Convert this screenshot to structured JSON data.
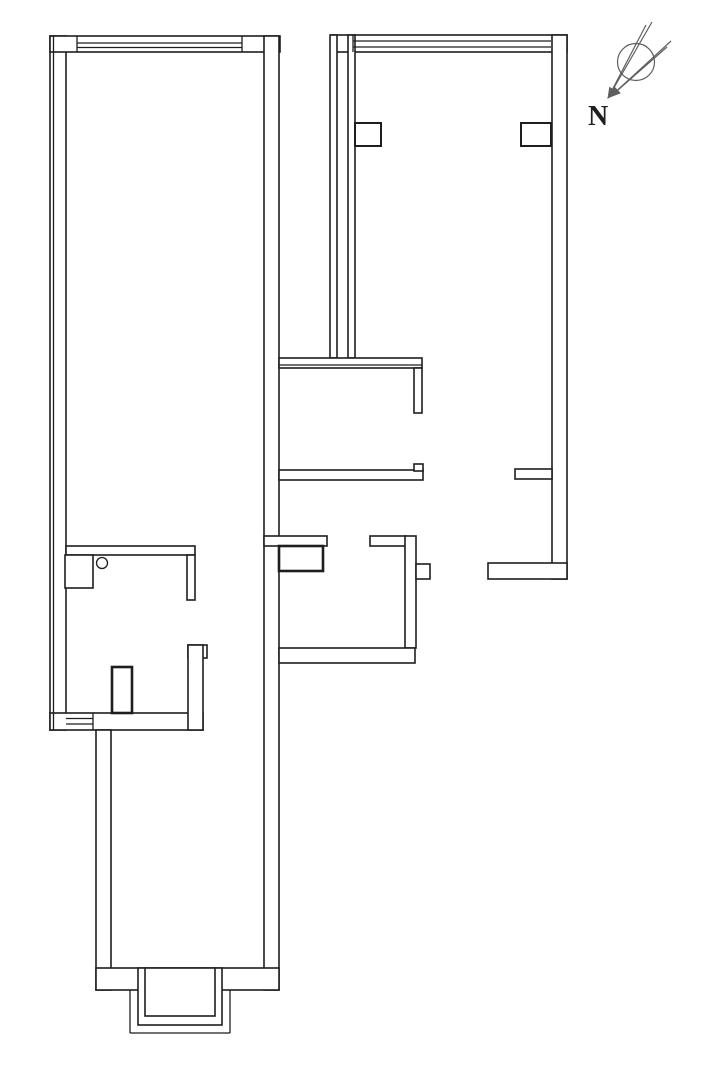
{
  "plan": {
    "title": "apartment-floor-plan",
    "canvas": {
      "width": 713,
      "height": 1074,
      "background": "#ffffff"
    },
    "colors": {
      "wall_stroke": "#1e1e1e",
      "wall_fill": "#ffffff",
      "thin_line": "#1e1e1e",
      "compass_stroke": "#5f5f5f",
      "label_color": "#1f1f1f"
    },
    "stroke_widths": {
      "wall": 1.6,
      "thick": 2.6,
      "line": 1.3,
      "compass": 1.2
    },
    "walls": [
      {
        "name": "outer-wall-left",
        "x": 50,
        "y": 36,
        "w": 16,
        "h": 694
      },
      {
        "name": "living-top-wall",
        "x": 50,
        "y": 36,
        "w": 230,
        "h": 16
      },
      {
        "name": "living-right-wall",
        "x": 264,
        "y": 36,
        "w": 15,
        "h": 954
      },
      {
        "name": "bedroom-top-wall",
        "x": 331,
        "y": 35,
        "w": 236,
        "h": 17
      },
      {
        "name": "bedroom-left-wall-outer",
        "x": 330,
        "y": 35,
        "w": 7,
        "h": 323
      },
      {
        "name": "bedroom-left-wall-inner",
        "x": 348,
        "y": 35,
        "w": 7,
        "h": 323
      },
      {
        "name": "bedroom-right-wall",
        "x": 552,
        "y": 35,
        "w": 15,
        "h": 544
      },
      {
        "name": "duct-box-left",
        "x": 355,
        "y": 123,
        "w": 26,
        "h": 23,
        "sw": 2.0
      },
      {
        "name": "duct-box-right",
        "x": 521,
        "y": 123,
        "w": 30,
        "h": 23,
        "sw": 2.0
      },
      {
        "name": "bath-top-wall",
        "x": 279,
        "y": 358,
        "w": 143,
        "h": 10
      },
      {
        "name": "bath-right-wall",
        "x": 414,
        "y": 368,
        "w": 8,
        "h": 45
      },
      {
        "name": "bath-bottom-wall",
        "x": 279,
        "y": 470,
        "w": 144,
        "h": 10
      },
      {
        "name": "bath-door-notch",
        "x": 414,
        "y": 464,
        "w": 9,
        "h": 7
      },
      {
        "name": "entry-stub-wall",
        "x": 515,
        "y": 469,
        "w": 37,
        "h": 10
      },
      {
        "name": "entry-bottom-wall",
        "x": 488,
        "y": 563,
        "w": 79,
        "h": 16
      },
      {
        "name": "kitchen-top-wall-left",
        "x": 264,
        "y": 536,
        "w": 63,
        "h": 10
      },
      {
        "name": "kitchen-top-wall-right",
        "x": 370,
        "y": 536,
        "w": 36,
        "h": 10
      },
      {
        "name": "kitchen-right-wall",
        "x": 405,
        "y": 536,
        "w": 11,
        "h": 112
      },
      {
        "name": "kitchen-stub-wall",
        "x": 416,
        "y": 564,
        "w": 14,
        "h": 15
      },
      {
        "name": "kitchen-bottom-wall",
        "x": 279,
        "y": 648,
        "w": 136,
        "h": 15
      },
      {
        "name": "kitchen-counter",
        "x": 279,
        "y": 546,
        "w": 44,
        "h": 25,
        "sw": 2.6
      },
      {
        "name": "bath2-top-wall",
        "x": 66,
        "y": 546,
        "w": 129,
        "h": 9
      },
      {
        "name": "bath2-right-wall",
        "x": 187,
        "y": 555,
        "w": 8,
        "h": 45
      },
      {
        "name": "washbasin",
        "x": 65,
        "y": 555,
        "w": 28,
        "h": 33
      },
      {
        "name": "hall-window-wall",
        "x": 50,
        "y": 713,
        "w": 153,
        "h": 17
      },
      {
        "name": "pipe-shaft",
        "x": 112,
        "y": 667,
        "w": 20,
        "h": 46,
        "sw": 2.6
      },
      {
        "name": "hall-wall-cap",
        "x": 188,
        "y": 645,
        "w": 19,
        "h": 13
      },
      {
        "name": "hall-wall",
        "x": 188,
        "y": 645,
        "w": 15,
        "h": 85
      },
      {
        "name": "balcony-room-left-wall",
        "x": 96,
        "y": 730,
        "w": 15,
        "h": 260
      },
      {
        "name": "balcony-bottom-wall-left",
        "x": 96,
        "y": 968,
        "w": 49,
        "h": 22
      },
      {
        "name": "balcony-bottom-wall-right",
        "x": 215,
        "y": 968,
        "w": 64,
        "h": 22
      },
      {
        "name": "bay-window-mid-rect",
        "x": 138,
        "y": 968,
        "w": 84,
        "h": 57
      },
      {
        "name": "bay-window-inner-rect",
        "x": 145,
        "y": 968,
        "w": 70,
        "h": 48
      }
    ],
    "lines": [
      {
        "name": "outer-wall-left-inner-line",
        "x1": 53.5,
        "y1": 36,
        "x2": 53.5,
        "y2": 730
      },
      {
        "name": "bath-top-wall-inner-line",
        "x1": 279,
        "y1": 365,
        "x2": 422,
        "y2": 365
      },
      {
        "name": "window-living-line-1",
        "x1": 77,
        "y1": 43,
        "x2": 242,
        "y2": 43
      },
      {
        "name": "window-living-line-2",
        "x1": 77,
        "y1": 47.5,
        "x2": 242,
        "y2": 47.5
      },
      {
        "name": "window-living-jamb-left",
        "x1": 77,
        "y1": 36,
        "x2": 77,
        "y2": 52
      },
      {
        "name": "window-living-jamb-right",
        "x1": 242,
        "y1": 36,
        "x2": 242,
        "y2": 52
      },
      {
        "name": "window-bedroom-line-1",
        "x1": 353,
        "y1": 41,
        "x2": 551,
        "y2": 41
      },
      {
        "name": "window-bedroom-line-2",
        "x1": 353,
        "y1": 47,
        "x2": 551,
        "y2": 47
      },
      {
        "name": "window-bedroom-jamb-left",
        "x1": 353,
        "y1": 35,
        "x2": 353,
        "y2": 52
      },
      {
        "name": "window-hall-line-1",
        "x1": 66,
        "y1": 718.5,
        "x2": 93,
        "y2": 718.5
      },
      {
        "name": "window-hall-line-2",
        "x1": 66,
        "y1": 724,
        "x2": 93,
        "y2": 724
      },
      {
        "name": "window-hall-jamb",
        "x1": 93,
        "y1": 713,
        "x2": 93,
        "y2": 730
      },
      {
        "name": "bay-outer-left",
        "x1": 130,
        "y1": 990,
        "x2": 130,
        "y2": 1033
      },
      {
        "name": "bay-outer-bottom",
        "x1": 130,
        "y1": 1033,
        "x2": 230,
        "y2": 1033
      },
      {
        "name": "bay-outer-right",
        "x1": 230,
        "y1": 990,
        "x2": 230,
        "y2": 1033
      }
    ],
    "fixtures": [
      {
        "name": "drain-circle",
        "type": "circle",
        "cx": 102,
        "cy": 563,
        "r": 5.5
      }
    ],
    "compass": {
      "label": "N",
      "label_x": 588,
      "label_y": 125,
      "circle": {
        "cx": 636,
        "cy": 62,
        "r": 18.5
      },
      "needle_lines": [
        {
          "name": "needle-1-edge-a",
          "x1": 652,
          "y1": 22,
          "x2": 608,
          "y2": 98
        },
        {
          "name": "needle-1-edge-b",
          "x1": 646,
          "y1": 25,
          "x2": 608,
          "y2": 98
        },
        {
          "name": "needle-2-edge-a",
          "x1": 671,
          "y1": 41,
          "x2": 610,
          "y2": 97
        },
        {
          "name": "needle-2-edge-b",
          "x1": 667,
          "y1": 47,
          "x2": 610,
          "y2": 97
        }
      ],
      "arrow_heads": [
        {
          "name": "needle-1-arrowhead",
          "points": "608,98 616.4,91.4 609.6,87.4"
        },
        {
          "name": "needle-2-arrowhead",
          "points": "610,97 620.1,93.1 614.7,87.3"
        }
      ]
    }
  }
}
